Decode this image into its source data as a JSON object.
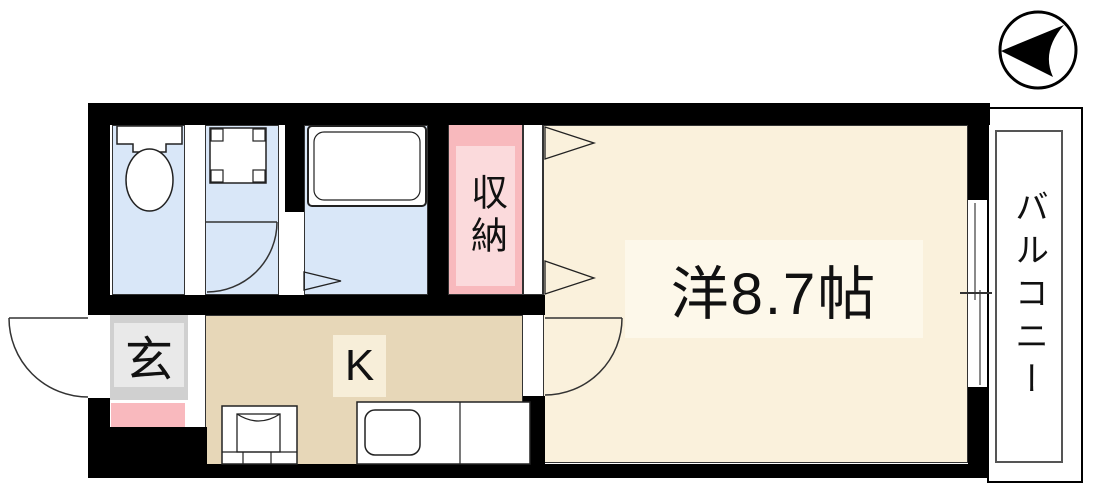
{
  "floorplan": {
    "title": "1K apartment floor plan",
    "wall_color": "#000000",
    "compass": {
      "icon": "north-arrow-icon",
      "points": "left",
      "color": "#000000"
    },
    "rooms": {
      "western_room": {
        "label": "洋8.7帖",
        "color": "#faf1dc",
        "label_bg": "#fdf8ea"
      },
      "kitchen": {
        "label": "K",
        "color": "#e7d7b8",
        "label_bg": "#f7eed9"
      },
      "closet": {
        "label": "収納",
        "color": "#f8b9bd",
        "inner_color": "#fbdadc"
      },
      "entrance": {
        "label": "玄",
        "color": "#d0d0d0",
        "inner_color": "#e9e9e9",
        "step_color": "#f9b9be"
      },
      "balcony": {
        "label": "バルコニー",
        "color": "#ffffff"
      },
      "toilet": {
        "color": "#d9e7f8"
      },
      "washroom": {
        "color": "#d9e7f8"
      },
      "bathroom": {
        "color": "#d9e7f8"
      }
    },
    "fixtures": [
      "toilet-icon",
      "vanity-sink-icon",
      "bathtub-icon",
      "washing-machine-icon",
      "kitchen-sink-counter-icon",
      "sliding-window-icon",
      "hinged-door-icon",
      "folding-door-icon"
    ]
  }
}
